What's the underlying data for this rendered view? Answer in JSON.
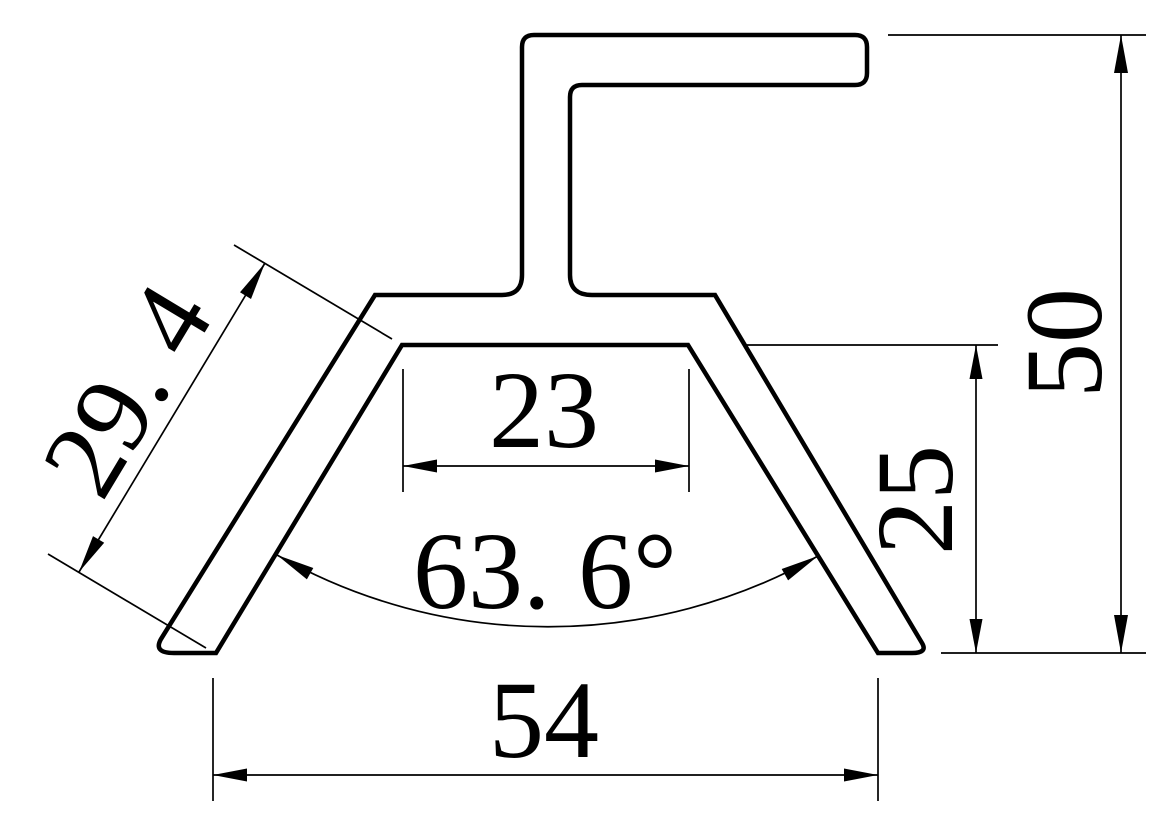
{
  "canvas": {
    "width": 1176,
    "height": 836,
    "background_color": "#ffffff",
    "line_color": "#000000"
  },
  "drawing": {
    "kind": "profile-cross-section",
    "dimension_labels": {
      "inner_top_width": "23",
      "inner_bottom_width": "54",
      "right_inner_height": "25",
      "overall_height": "50",
      "left_leg_inner_length": "29. 4",
      "legs_included_angle": "63. 6°"
    }
  }
}
